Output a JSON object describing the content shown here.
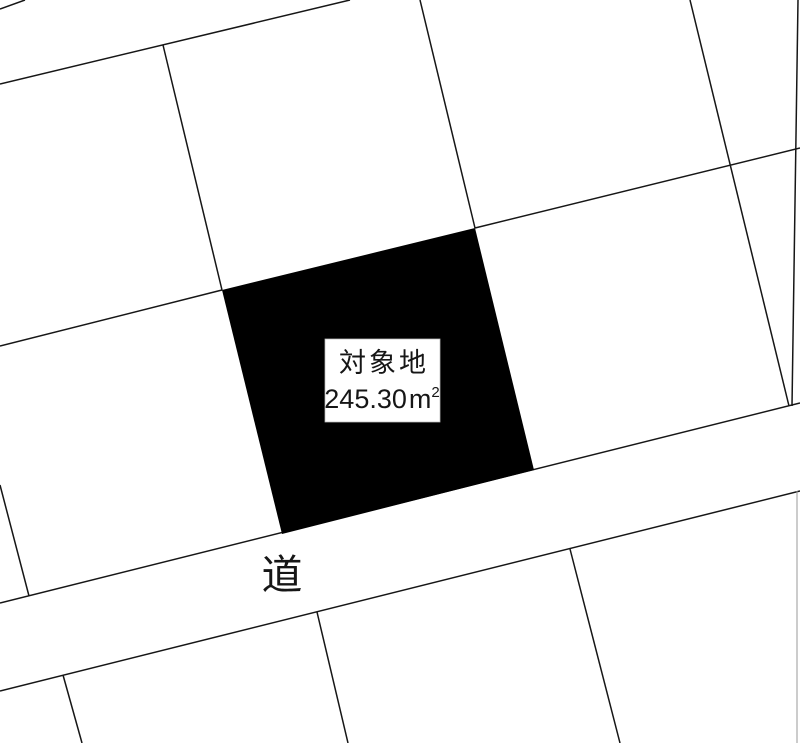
{
  "map": {
    "target_parcel": {
      "label": "対象地",
      "area_value": "245.30",
      "area_unit": "m",
      "area_unit_exponent": "2"
    },
    "road": {
      "label": "道"
    },
    "colors": {
      "background": "#ffffff",
      "boundary_line": "#161616",
      "target_parcel_fill": "#000000",
      "label_box_background": "#ffffff"
    }
  }
}
